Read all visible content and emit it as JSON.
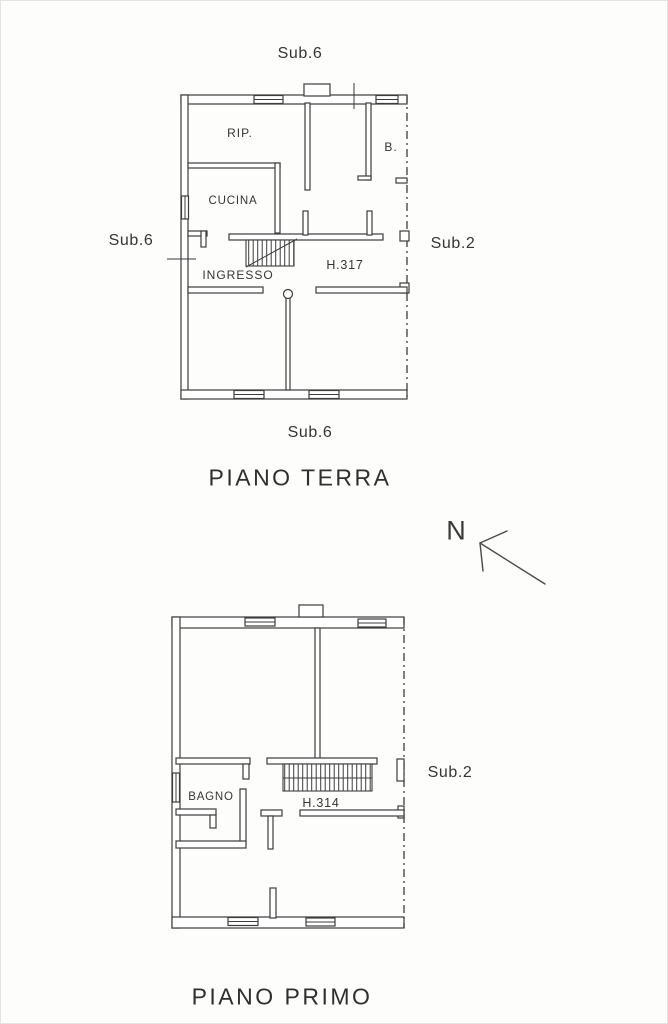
{
  "colors": {
    "ink": "#3c3c3c",
    "paper": "#fdfdfb"
  },
  "ground_floor": {
    "sub_top": "Sub.6",
    "sub_left": "Sub.6",
    "sub_right": "Sub.2",
    "sub_bottom": "Sub.6",
    "rooms": {
      "rip": "RIP.",
      "b": "B.",
      "cucina": "CUCINA",
      "ingresso": "INGRESSO"
    },
    "height_label": "H.317",
    "title": "PIANO TERRA"
  },
  "compass": {
    "north": "N"
  },
  "first_floor": {
    "sub_right": "Sub.2",
    "rooms": {
      "bagno": "BAGNO"
    },
    "height_label": "H.314",
    "title": "PIANO PRIMO"
  }
}
